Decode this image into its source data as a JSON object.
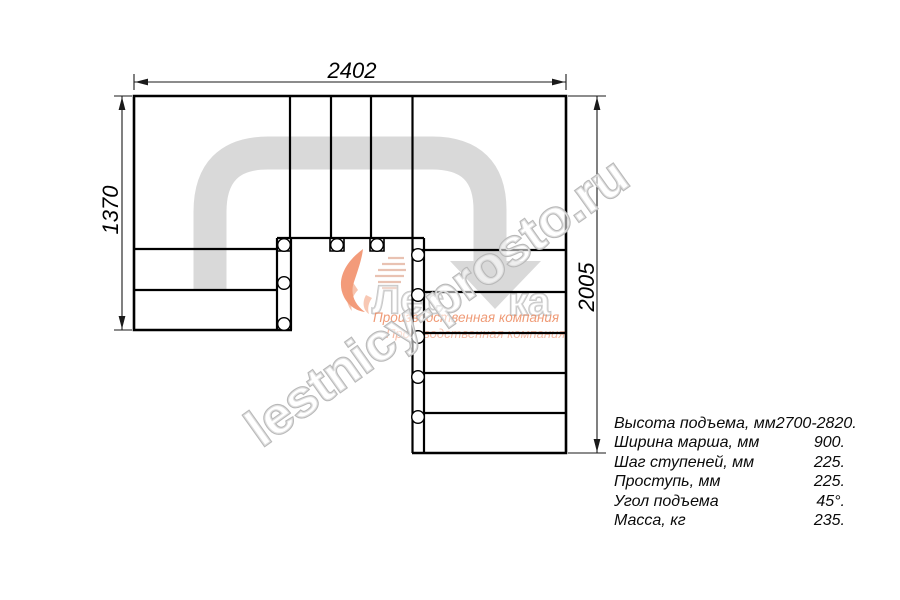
{
  "dimensions": {
    "top_width_mm": "2402",
    "left_height_mm": "1370",
    "right_height_mm": "2005"
  },
  "specs": {
    "rows": [
      {
        "label": "Высота подъема, мм",
        "value": "2700-2820."
      },
      {
        "label": "Ширина марша, мм",
        "value": "900."
      },
      {
        "label": "Шаг ступеней, мм",
        "value": "225."
      },
      {
        "label": "Проступь, мм",
        "value": "225."
      },
      {
        "label": "Угол подъема",
        "value": "45°."
      },
      {
        "label": "Масса, кг",
        "value": "235."
      }
    ]
  },
  "watermark": {
    "site_text": "lestnicy-prosto.ru",
    "brand_left": "Лес",
    "brand_right": "ка",
    "tagline1": "Производственная компания",
    "tagline2": "Производственная компания"
  },
  "colors": {
    "line": "#000000",
    "dimension_line": "#1a1a1a",
    "walkline_gray": "#d9d9d9",
    "watermark_outline": "#b9b9b9",
    "logo_orange": "#ef7a4e",
    "tagline_orange": "#ed8a60"
  }
}
